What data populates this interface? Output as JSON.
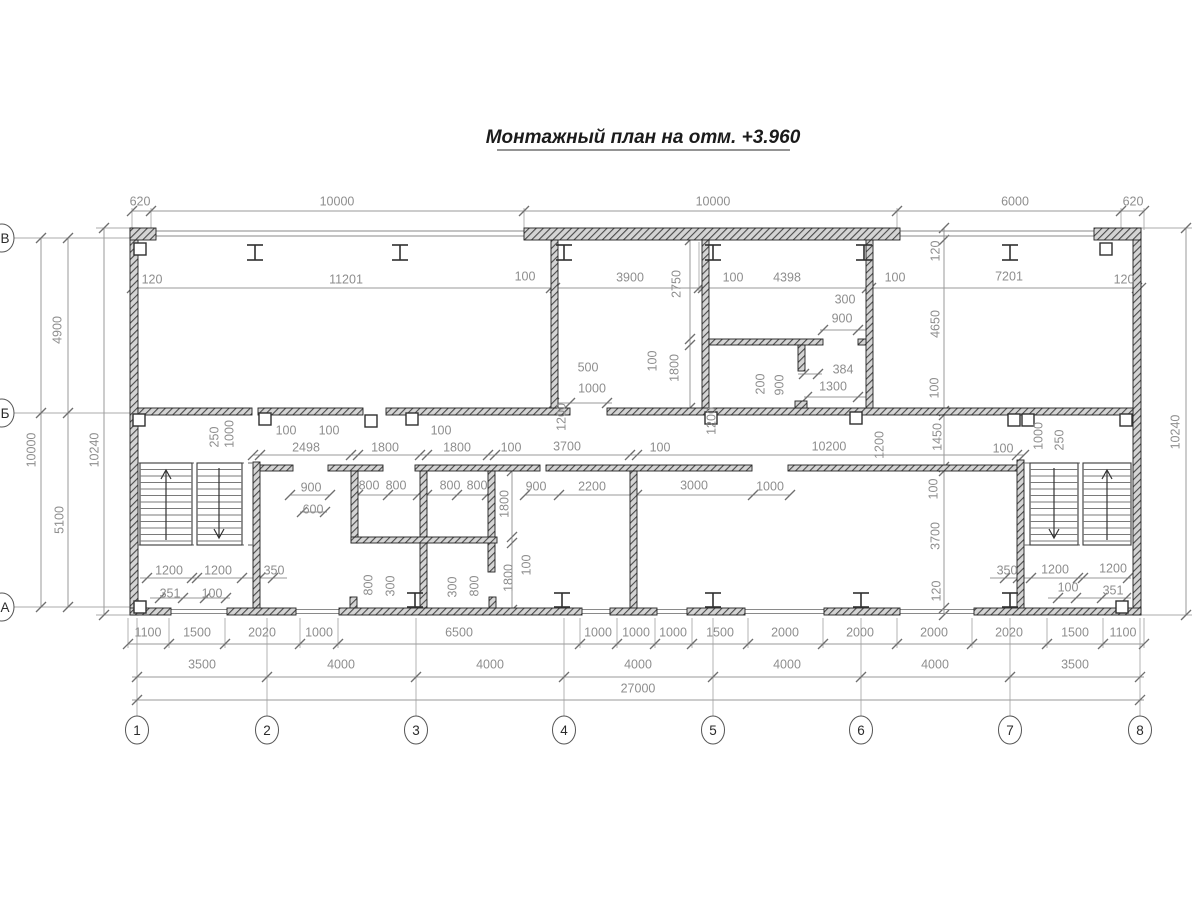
{
  "title": {
    "text": "Монтажный план на отм. +3.960"
  },
  "axes": {
    "bottom": [
      {
        "label": "1",
        "x": 137
      },
      {
        "label": "2",
        "x": 267
      },
      {
        "label": "3",
        "x": 416
      },
      {
        "label": "4",
        "x": 564
      },
      {
        "label": "5",
        "x": 713
      },
      {
        "label": "6",
        "x": 861
      },
      {
        "label": "7",
        "x": 1010
      },
      {
        "label": "8",
        "x": 1140
      }
    ],
    "left": [
      {
        "label": "В",
        "y": 238
      },
      {
        "label": "Б",
        "y": 413
      },
      {
        "label": "А",
        "y": 607
      }
    ]
  },
  "dimensions": [
    {
      "t": "620",
      "x": 140,
      "y": 202,
      "r": 0
    },
    {
      "t": "10000",
      "x": 337,
      "y": 202,
      "r": 0
    },
    {
      "t": "10000",
      "x": 713,
      "y": 202,
      "r": 0
    },
    {
      "t": "6000",
      "x": 1015,
      "y": 202,
      "r": 0
    },
    {
      "t": "620",
      "x": 1133,
      "y": 202,
      "r": 0
    },
    {
      "t": "120",
      "x": 152,
      "y": 280,
      "r": 0
    },
    {
      "t": "11201",
      "x": 346,
      "y": 280,
      "r": 0
    },
    {
      "t": "100",
      "x": 525,
      "y": 277,
      "r": 0
    },
    {
      "t": "3900",
      "x": 630,
      "y": 278,
      "r": 0
    },
    {
      "t": "100",
      "x": 733,
      "y": 278,
      "r": 0
    },
    {
      "t": "4398",
      "x": 787,
      "y": 278,
      "r": 0
    },
    {
      "t": "100",
      "x": 895,
      "y": 278,
      "r": 0
    },
    {
      "t": "7201",
      "x": 1009,
      "y": 277,
      "r": 0
    },
    {
      "t": "120",
      "x": 1124,
      "y": 280,
      "r": 0
    },
    {
      "t": "2750",
      "x": 677,
      "y": 284,
      "r": 1
    },
    {
      "t": "100",
      "x": 653,
      "y": 361,
      "r": 1
    },
    {
      "t": "1800",
      "x": 675,
      "y": 368,
      "r": 1
    },
    {
      "t": "500",
      "x": 588,
      "y": 368,
      "r": 0
    },
    {
      "t": "1000",
      "x": 592,
      "y": 389,
      "r": 0
    },
    {
      "t": "300",
      "x": 845,
      "y": 300,
      "r": 0
    },
    {
      "t": "900",
      "x": 842,
      "y": 319,
      "r": 0
    },
    {
      "t": "384",
      "x": 843,
      "y": 370,
      "r": 0
    },
    {
      "t": "1300",
      "x": 833,
      "y": 387,
      "r": 0
    },
    {
      "t": "200",
      "x": 761,
      "y": 384,
      "r": 1
    },
    {
      "t": "900",
      "x": 780,
      "y": 385,
      "r": 1
    },
    {
      "t": "120",
      "x": 936,
      "y": 251,
      "r": 1
    },
    {
      "t": "4650",
      "x": 936,
      "y": 324,
      "r": 1
    },
    {
      "t": "100",
      "x": 935,
      "y": 388,
      "r": 1
    },
    {
      "t": "1450",
      "x": 938,
      "y": 437,
      "r": 1
    },
    {
      "t": "100",
      "x": 934,
      "y": 489,
      "r": 1
    },
    {
      "t": "3700",
      "x": 936,
      "y": 536,
      "r": 1
    },
    {
      "t": "120",
      "x": 937,
      "y": 591,
      "r": 1
    },
    {
      "t": "4900",
      "x": 58,
      "y": 330,
      "r": 1
    },
    {
      "t": "10000",
      "x": 32,
      "y": 450,
      "r": 1
    },
    {
      "t": "10240",
      "x": 95,
      "y": 450,
      "r": 1
    },
    {
      "t": "5100",
      "x": 60,
      "y": 520,
      "r": 1
    },
    {
      "t": "10240",
      "x": 1176,
      "y": 432,
      "r": 1
    },
    {
      "t": "100",
      "x": 286,
      "y": 431,
      "r": 0
    },
    {
      "t": "100",
      "x": 329,
      "y": 431,
      "r": 0
    },
    {
      "t": "2498",
      "x": 306,
      "y": 448,
      "r": 0
    },
    {
      "t": "1800",
      "x": 385,
      "y": 448,
      "r": 0
    },
    {
      "t": "100",
      "x": 441,
      "y": 431,
      "r": 0
    },
    {
      "t": "1800",
      "x": 457,
      "y": 448,
      "r": 0
    },
    {
      "t": "100",
      "x": 511,
      "y": 448,
      "r": 0
    },
    {
      "t": "3700",
      "x": 567,
      "y": 447,
      "r": 0
    },
    {
      "t": "100",
      "x": 660,
      "y": 448,
      "r": 0
    },
    {
      "t": "10200",
      "x": 829,
      "y": 447,
      "r": 0
    },
    {
      "t": "100",
      "x": 1003,
      "y": 449,
      "r": 0
    },
    {
      "t": "250",
      "x": 215,
      "y": 437,
      "r": 1
    },
    {
      "t": "1000",
      "x": 230,
      "y": 434,
      "r": 1
    },
    {
      "t": "1200",
      "x": 562,
      "y": 417,
      "r": 1
    },
    {
      "t": "1200",
      "x": 712,
      "y": 421,
      "r": 1
    },
    {
      "t": "1200",
      "x": 880,
      "y": 445,
      "r": 1
    },
    {
      "t": "1000",
      "x": 1039,
      "y": 436,
      "r": 1
    },
    {
      "t": "250",
      "x": 1060,
      "y": 440,
      "r": 1
    },
    {
      "t": "900",
      "x": 311,
      "y": 488,
      "r": 0
    },
    {
      "t": "600",
      "x": 313,
      "y": 510,
      "r": 0
    },
    {
      "t": "800",
      "x": 369,
      "y": 486,
      "r": 0
    },
    {
      "t": "800",
      "x": 396,
      "y": 486,
      "r": 0
    },
    {
      "t": "800",
      "x": 450,
      "y": 486,
      "r": 0
    },
    {
      "t": "800",
      "x": 477,
      "y": 486,
      "r": 0
    },
    {
      "t": "900",
      "x": 536,
      "y": 487,
      "r": 0
    },
    {
      "t": "2200",
      "x": 592,
      "y": 487,
      "r": 0
    },
    {
      "t": "3000",
      "x": 694,
      "y": 486,
      "r": 0
    },
    {
      "t": "1000",
      "x": 770,
      "y": 487,
      "r": 0
    },
    {
      "t": "1800",
      "x": 505,
      "y": 504,
      "r": 1
    },
    {
      "t": "100",
      "x": 527,
      "y": 565,
      "r": 1
    },
    {
      "t": "1800",
      "x": 509,
      "y": 578,
      "r": 1
    },
    {
      "t": "800",
      "x": 369,
      "y": 585,
      "r": 1
    },
    {
      "t": "300",
      "x": 391,
      "y": 586,
      "r": 1
    },
    {
      "t": "300",
      "x": 453,
      "y": 587,
      "r": 1
    },
    {
      "t": "800",
      "x": 475,
      "y": 586,
      "r": 1
    },
    {
      "t": "1200",
      "x": 169,
      "y": 571,
      "r": 0
    },
    {
      "t": "1200",
      "x": 218,
      "y": 571,
      "r": 0
    },
    {
      "t": "350",
      "x": 274,
      "y": 571,
      "r": 0
    },
    {
      "t": "351",
      "x": 170,
      "y": 594,
      "r": 0
    },
    {
      "t": "100",
      "x": 212,
      "y": 594,
      "r": 0
    },
    {
      "t": "350",
      "x": 1007,
      "y": 571,
      "r": 0
    },
    {
      "t": "1200",
      "x": 1055,
      "y": 570,
      "r": 0
    },
    {
      "t": "1200",
      "x": 1113,
      "y": 569,
      "r": 0
    },
    {
      "t": "100",
      "x": 1068,
      "y": 588,
      "r": 0
    },
    {
      "t": "351",
      "x": 1113,
      "y": 591,
      "r": 0
    },
    {
      "t": "1100",
      "x": 148,
      "y": 633,
      "r": 0
    },
    {
      "t": "1500",
      "x": 197,
      "y": 633,
      "r": 0
    },
    {
      "t": "2020",
      "x": 262,
      "y": 633,
      "r": 0
    },
    {
      "t": "1000",
      "x": 319,
      "y": 633,
      "r": 0
    },
    {
      "t": "6500",
      "x": 459,
      "y": 633,
      "r": 0
    },
    {
      "t": "1000",
      "x": 598,
      "y": 633,
      "r": 0
    },
    {
      "t": "1000",
      "x": 636,
      "y": 633,
      "r": 0
    },
    {
      "t": "1000",
      "x": 673,
      "y": 633,
      "r": 0
    },
    {
      "t": "1500",
      "x": 720,
      "y": 633,
      "r": 0
    },
    {
      "t": "2000",
      "x": 785,
      "y": 633,
      "r": 0
    },
    {
      "t": "2000",
      "x": 860,
      "y": 633,
      "r": 0
    },
    {
      "t": "2000",
      "x": 934,
      "y": 633,
      "r": 0
    },
    {
      "t": "2020",
      "x": 1009,
      "y": 633,
      "r": 0
    },
    {
      "t": "1500",
      "x": 1075,
      "y": 633,
      "r": 0
    },
    {
      "t": "1100",
      "x": 1123,
      "y": 633,
      "r": 0
    },
    {
      "t": "3500",
      "x": 202,
      "y": 665,
      "r": 0
    },
    {
      "t": "4000",
      "x": 341,
      "y": 665,
      "r": 0
    },
    {
      "t": "4000",
      "x": 490,
      "y": 665,
      "r": 0
    },
    {
      "t": "4000",
      "x": 638,
      "y": 665,
      "r": 0
    },
    {
      "t": "4000",
      "x": 787,
      "y": 665,
      "r": 0
    },
    {
      "t": "4000",
      "x": 935,
      "y": 665,
      "r": 0
    },
    {
      "t": "3500",
      "x": 1075,
      "y": 665,
      "r": 0
    },
    {
      "t": "27000",
      "x": 638,
      "y": 689,
      "r": 0
    }
  ]
}
